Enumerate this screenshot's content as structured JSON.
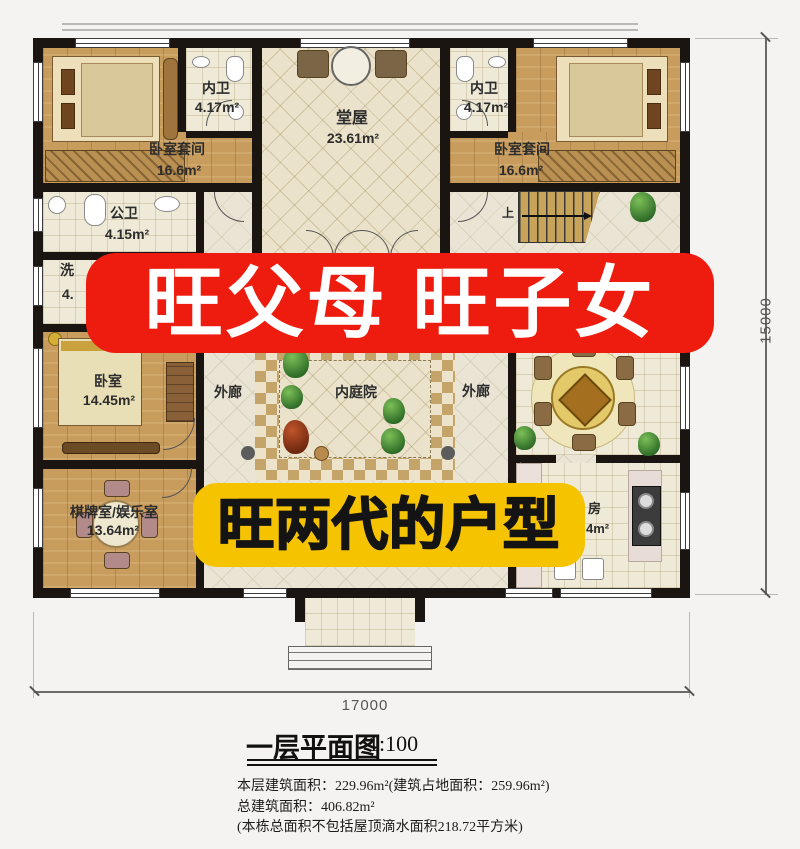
{
  "banners": {
    "red": {
      "text": "旺父母 旺子女",
      "bg": "#ee1c0f",
      "fg": "#ffffff"
    },
    "yellow": {
      "text": "旺两代的户型",
      "bg": "#f6c300",
      "fg": "#141414"
    }
  },
  "rooms": {
    "bedroom_suite_left": {
      "name": "卧室套间",
      "area": "16.6m²"
    },
    "inner_bath_left": {
      "name": "内卫",
      "area": "4.17m²"
    },
    "hall": {
      "name": "堂屋",
      "area": "23.61m²"
    },
    "inner_bath_right": {
      "name": "内卫",
      "area": "4.17m²"
    },
    "bedroom_suite_right": {
      "name": "卧室套间",
      "area": "16.6m²"
    },
    "public_bath": {
      "name": "公卫",
      "area": "4.15m²"
    },
    "laundry": {
      "name": "洗",
      "area": "4."
    },
    "bedroom": {
      "name": "卧室",
      "area": "14.45m²"
    },
    "game_room": {
      "name": "棋牌室/娱乐室",
      "area": "13.64m²"
    },
    "corridor_west": {
      "name": "外廊"
    },
    "courtyard": {
      "name": "内庭院"
    },
    "corridor_east": {
      "name": "外廊"
    },
    "kitchen": {
      "name": "房",
      "area": "4m²"
    },
    "stair": {
      "label": "上"
    }
  },
  "dimensions": {
    "width": "17000",
    "height": "15000"
  },
  "title_block": {
    "title": "一层平面图",
    "scale": "1:100",
    "line1": "本层建筑面积：229.96m²(建筑占地面积：259.96m²)",
    "line2": "总建筑面积：406.82m²",
    "line3": "(本栋总面积不包括屋顶滴水面积218.72平方米)"
  }
}
